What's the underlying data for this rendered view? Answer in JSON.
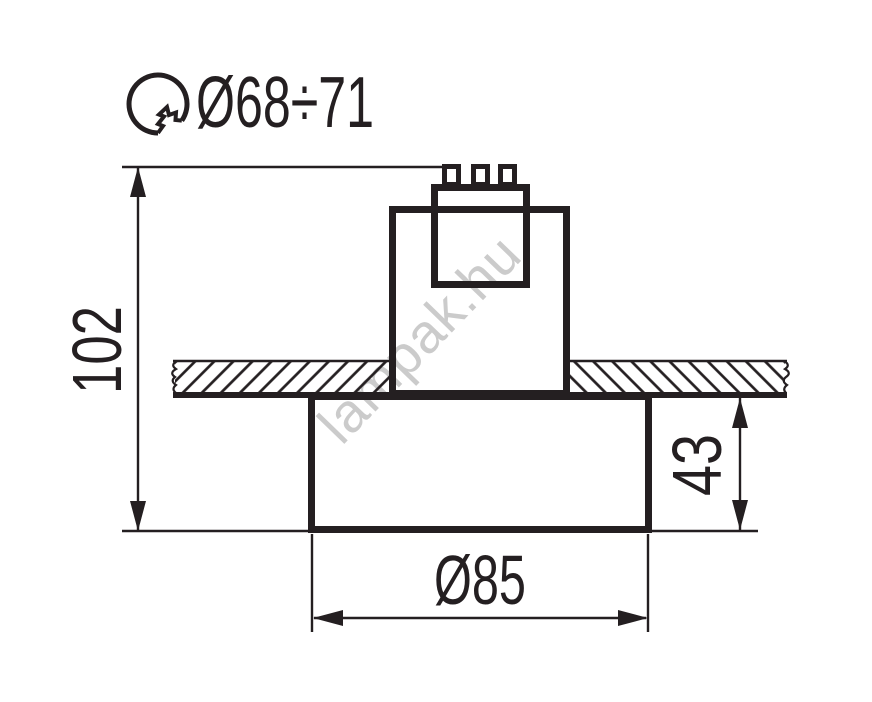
{
  "watermark": {
    "text": "lampak.hu"
  },
  "cutout_spec": {
    "icon": "hole-saw-icon",
    "label": "Ø68÷71"
  },
  "dimensions": {
    "total_height": "102",
    "visible_height": "43",
    "trim_diameter": "Ø85"
  },
  "colors": {
    "line": "#241f21",
    "watermark": "#cbcbcb",
    "background": "#ffffff"
  }
}
